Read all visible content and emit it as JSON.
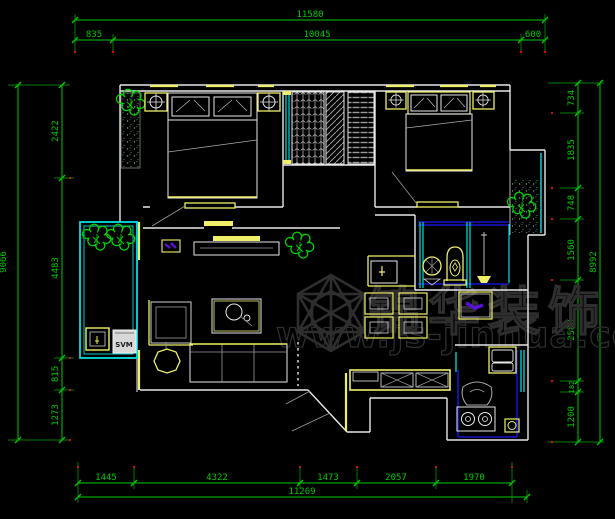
{
  "watermark": {
    "brand": "锦华装饰",
    "url": "www.js-jinhua.com"
  },
  "labels": {
    "washing_machine": "SVM"
  },
  "dimensions": {
    "top": {
      "total": "11580",
      "segments": [
        "835",
        "10045",
        "600"
      ]
    },
    "bottom": {
      "segments": [
        "1445",
        "4322",
        "1473",
        "2057",
        "1970"
      ],
      "total": "11269"
    },
    "left": {
      "outer_total": "9066",
      "segments": [
        "2422",
        "4483",
        "815",
        "1273"
      ]
    },
    "right": {
      "segments": [
        "734",
        "1835",
        "748",
        "1560",
        "2588",
        "182",
        "1200"
      ],
      "outer_total": "8992"
    }
  },
  "colors": {
    "dimension": "#00c800",
    "wall": "#e8e8e8",
    "furniture_yellow": "#efef68",
    "window_cyan": "#00dede",
    "accent_blue": "#1414cc",
    "plant_green": "#00d400",
    "hatch_gray": "#9a9a9a",
    "watermark_gray": "#2e2e2e",
    "marker_red": "#cc1111",
    "purple": "#5a10d8"
  }
}
